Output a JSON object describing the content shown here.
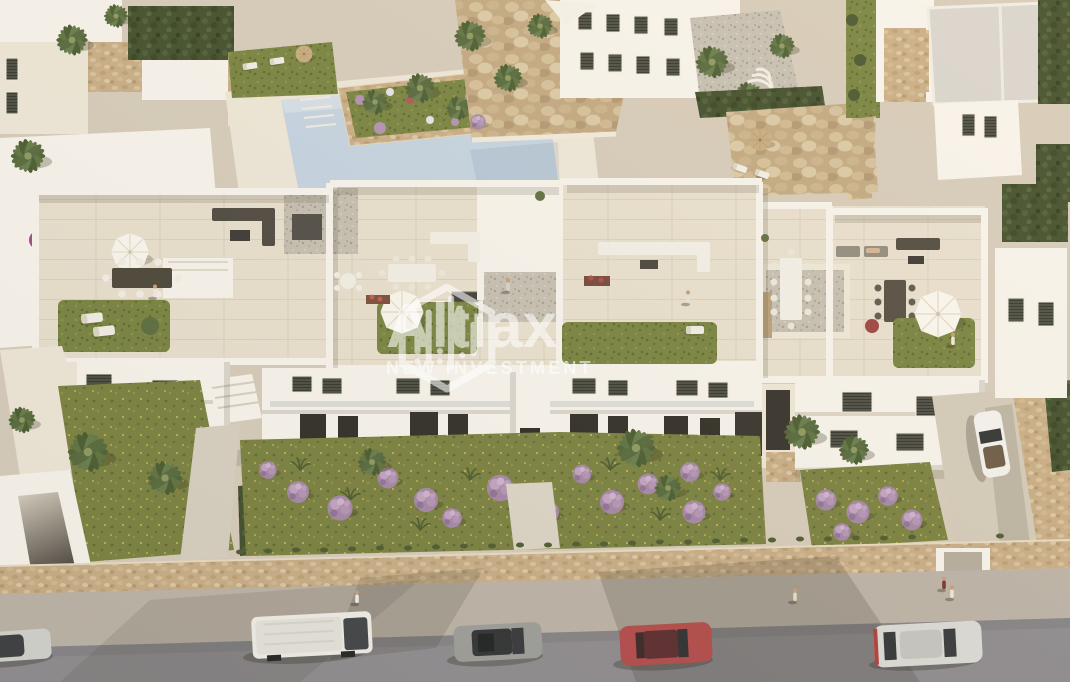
{
  "watermark": {
    "brand": "Altiax",
    "tagline": "NEW INVESTMENT",
    "icon": "hexagon-skyline-logo",
    "color": "#ffffff"
  },
  "scene": {
    "type": "aerial-architectural-render",
    "subject": "White Mediterranean apartment complex with rooftop solarium terraces, communal pool, gardens and street parking",
    "palette": {
      "building": "#f7f3ea",
      "terrace_floor": "#e8e0cf",
      "lawn": "#76823f",
      "rock": "#c6ad85",
      "pool": "#c5d5e4",
      "road": "#8e8c90",
      "sidewalk": "#bcb4a8",
      "stone_wall": "#c9ae87",
      "hedge": "#3e4c2a",
      "purple_flowers": "#ab8cae",
      "furniture_dark": "#4c4840",
      "furniture_white": "#f4f1e9"
    },
    "vehicles": [
      {
        "name": "white-van",
        "color": "#f1efe9"
      },
      {
        "name": "gray-hatchback",
        "color": "#9d9e9a"
      },
      {
        "name": "red-coupe",
        "color": "#b24a4a"
      },
      {
        "name": "silver-sedan",
        "color": "#dcdcd8"
      },
      {
        "name": "white-convertible-driveway",
        "color": "#f5f4f0"
      },
      {
        "name": "silver-car-corner",
        "color": "#d3d4d0"
      }
    ],
    "pedestrian_count": 4
  }
}
